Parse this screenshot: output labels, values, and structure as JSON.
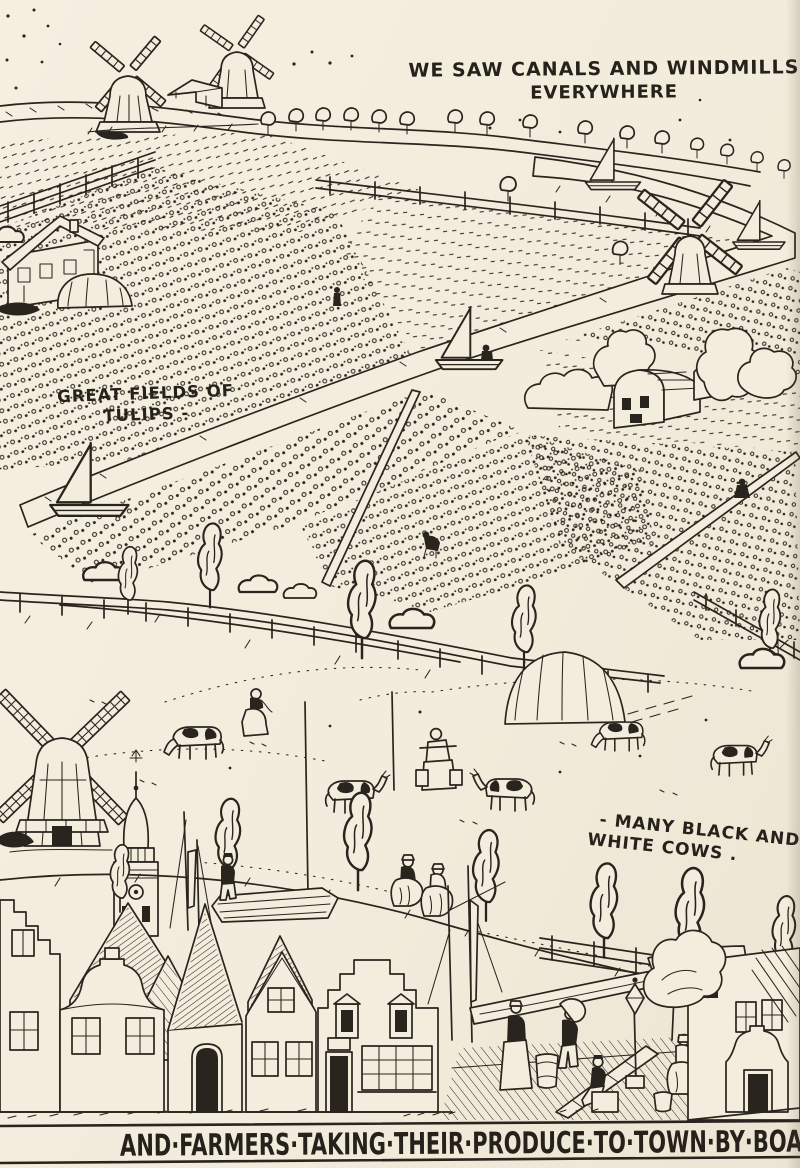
{
  "page": {
    "paper_color": "#f2ecdc",
    "ink_color": "#2a241e"
  },
  "captions": {
    "canals_line1": "WE SAW CANALS AND WINDMILLS",
    "canals_line2": "EVERYWHERE",
    "tulips_line1": "GREAT FIELDS OF",
    "tulips_line2": "TULIPS -",
    "cows_line1": "- MANY BLACK AND",
    "cows_line2": "WHITE COWS .",
    "bottom_banner": "AND·FARMERS·TAKING·THEIR·PRODUCE·TO·TOWN·BY·BOAT·"
  },
  "scene": {
    "style": "pen-and-ink storybook illustration of Holland",
    "elements": [
      "windmills",
      "canal with sailboats",
      "row of trees along road",
      "rail fences",
      "farmhouse",
      "tulip fields in rows",
      "farm barn",
      "meadow",
      "black and white cows",
      "milkmaids",
      "haystack",
      "large windmill",
      "church spire",
      "canal barge",
      "dutch stepped-gable town houses",
      "quay with figures and barrels",
      "street trees"
    ]
  }
}
